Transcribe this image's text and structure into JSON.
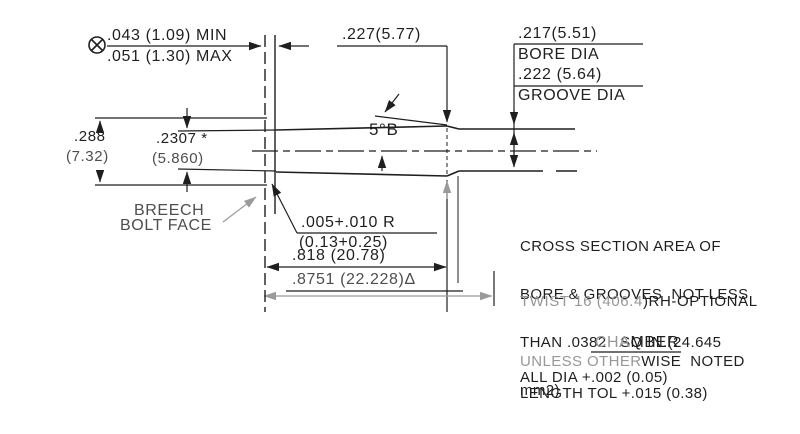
{
  "drawing": {
    "colors": {
      "ink": "#1f1f1f",
      "mid": "#4e4e4e",
      "faded": "#979797"
    },
    "dims": {
      "headspace_min": ".043 (1.09) MIN",
      "headspace_max": ".051 (1.30) MAX",
      "mouth_dia": ".227(5.77)",
      "bore_dia_value": ".217(5.51)",
      "bore_dia_label": "BORE DIA",
      "groove_dia_value": ".222 (5.64)",
      "groove_dia_label": "GROOVE DIA",
      "rim_dia_in": ".288",
      "rim_dia_mm": "(7.32)",
      "base_dia_in": ".2307 *",
      "base_dia_mm": "(5.860)",
      "taper_angle": "5°B",
      "radius_in": ".005+.010 R",
      "radius_mm": "(0.13+0.25)",
      "case_length": ".818 (20.78)",
      "chamber_length": ".8751 (22.228)Δ"
    },
    "labels": {
      "breech_line1": "BREECH",
      "breech_line2": "BOLT FACE"
    },
    "notes": {
      "cross_section": [
        "CROSS SECTION AREA OF",
        "BORE & GROOVES  NOT LESS",
        "THAN .0382   SQ IN.(24.645",
        "mm2)"
      ],
      "twist_light": "TWIST 16 (406.4",
      "twist_dark": ")RH-OPTIONAL",
      "chamber_title_light": "CHA",
      "chamber_title_dark": "MBER",
      "note1_light": "UNLESS OTHER",
      "note1_dark": "WISE  NOTED",
      "note2": "ALL DIA +.002 (0.05)",
      "note3": "LENGTH TOL +.015 (0.38)"
    }
  }
}
